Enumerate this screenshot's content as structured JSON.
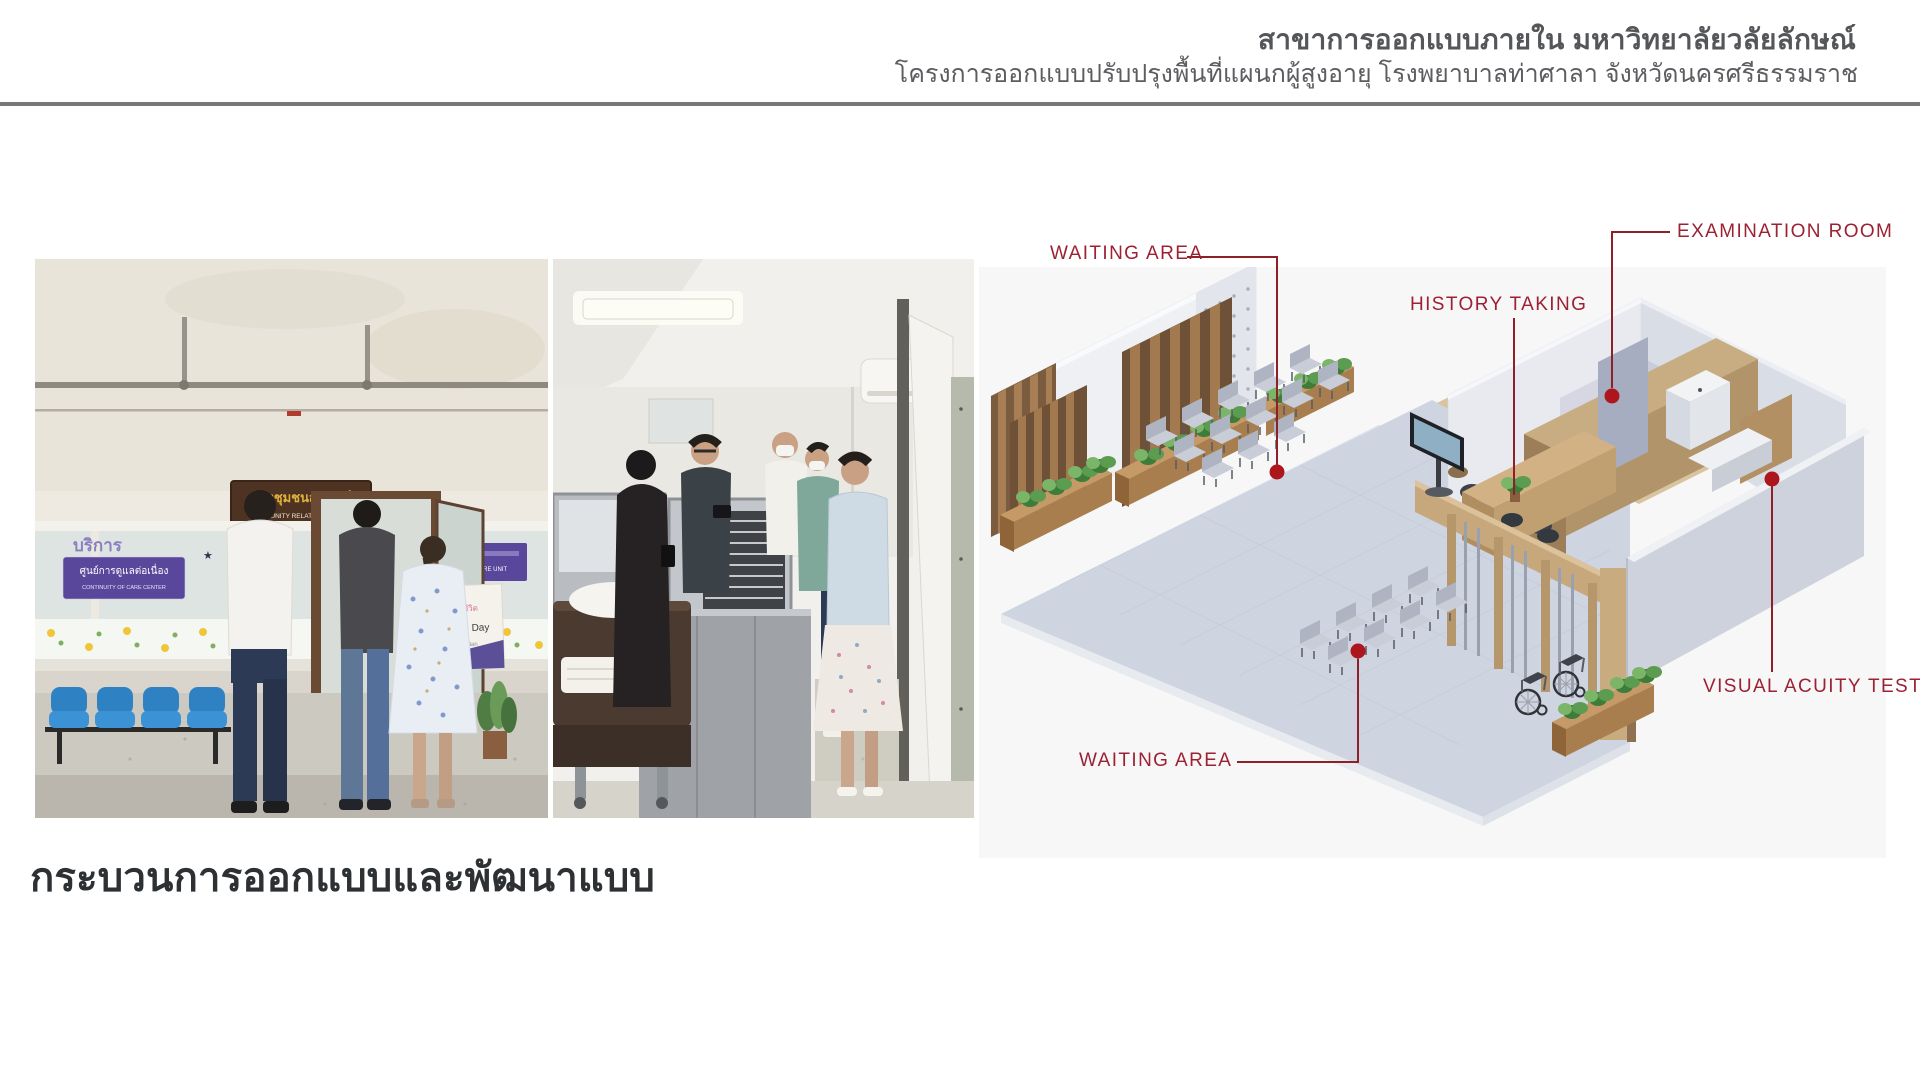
{
  "header": {
    "department": "สาขาการออกแบบภายใน มหาวิทยาลัยวลัยลักษณ์",
    "project": "โครงการออกแบบปรับปรุงพื้นที่แผนกผู้สูงอายุ โรงพยาบาลท่าศาลา  จังหวัดนครศรีธรรมราช"
  },
  "section": {
    "title": "กระบวนการออกแบบและพัฒนาแบบ"
  },
  "photos": {
    "photo1": {
      "sign_thai": "ห้องชุมชนสัมพันธ์",
      "sign_en": "COMMUNITY RELATION CENTER",
      "glass_text": "บริการ",
      "left_sign_thai": "ศูนย์การดูแลต่อเนื่อง",
      "left_sign_en": "CONTINUITY OF CARE CENTER",
      "right_sign_en": "CARE UNIT",
      "card_line1": "Life Day",
      "card_line2": "Plan"
    }
  },
  "plan": {
    "annotations": [
      {
        "id": "waiting-area-top",
        "label": "WAITING AREA"
      },
      {
        "id": "history-taking",
        "label": "HISTORY TAKING"
      },
      {
        "id": "examination-room",
        "label": "EXAMINATION ROOM"
      },
      {
        "id": "visual-acuity-test",
        "label": "VISUAL ACUITY TEST"
      },
      {
        "id": "waiting-area-bottom",
        "label": "WAITING AREA"
      }
    ],
    "colors": {
      "label": "#9c2133",
      "line": "#8e2028",
      "dot": "#ad161c"
    }
  }
}
